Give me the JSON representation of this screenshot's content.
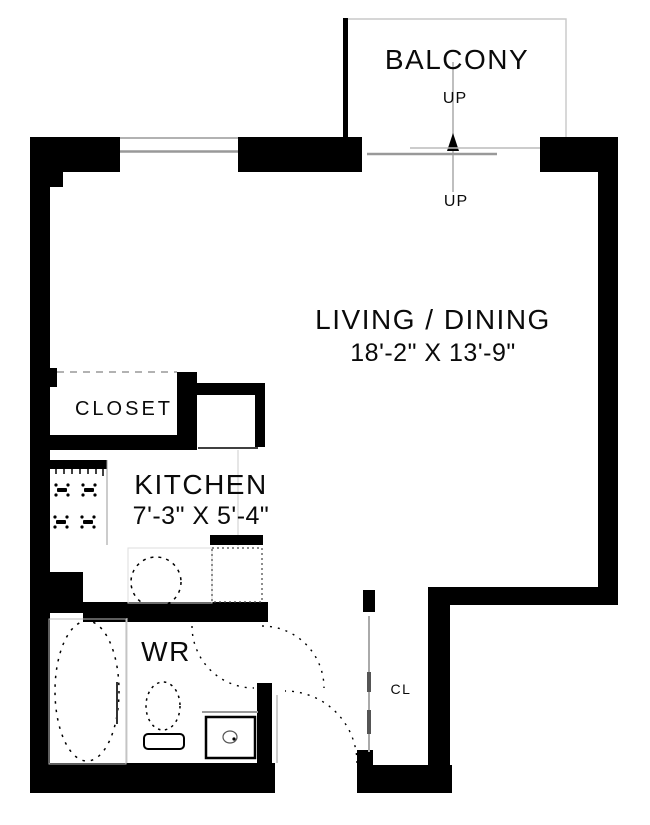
{
  "title": "Studio Apartment Floor Plan",
  "rooms": {
    "balcony": {
      "label": "BALCONY",
      "up": "UP"
    },
    "living": {
      "label": "LIVING / DINING",
      "dims": "18'-2\" X 13'-9\"",
      "up": "UP"
    },
    "kitchen": {
      "label": "KITCHEN",
      "dims": "7'-3\" X 5'-4\""
    },
    "closet": {
      "label": "CLOSET"
    },
    "washroom": {
      "label": "WR"
    },
    "hall_closet": {
      "label": "CL"
    }
  },
  "colors": {
    "wall": "#000000",
    "background": "#ffffff",
    "thin_line": "#999999",
    "light_line": "#c8c8c8"
  }
}
